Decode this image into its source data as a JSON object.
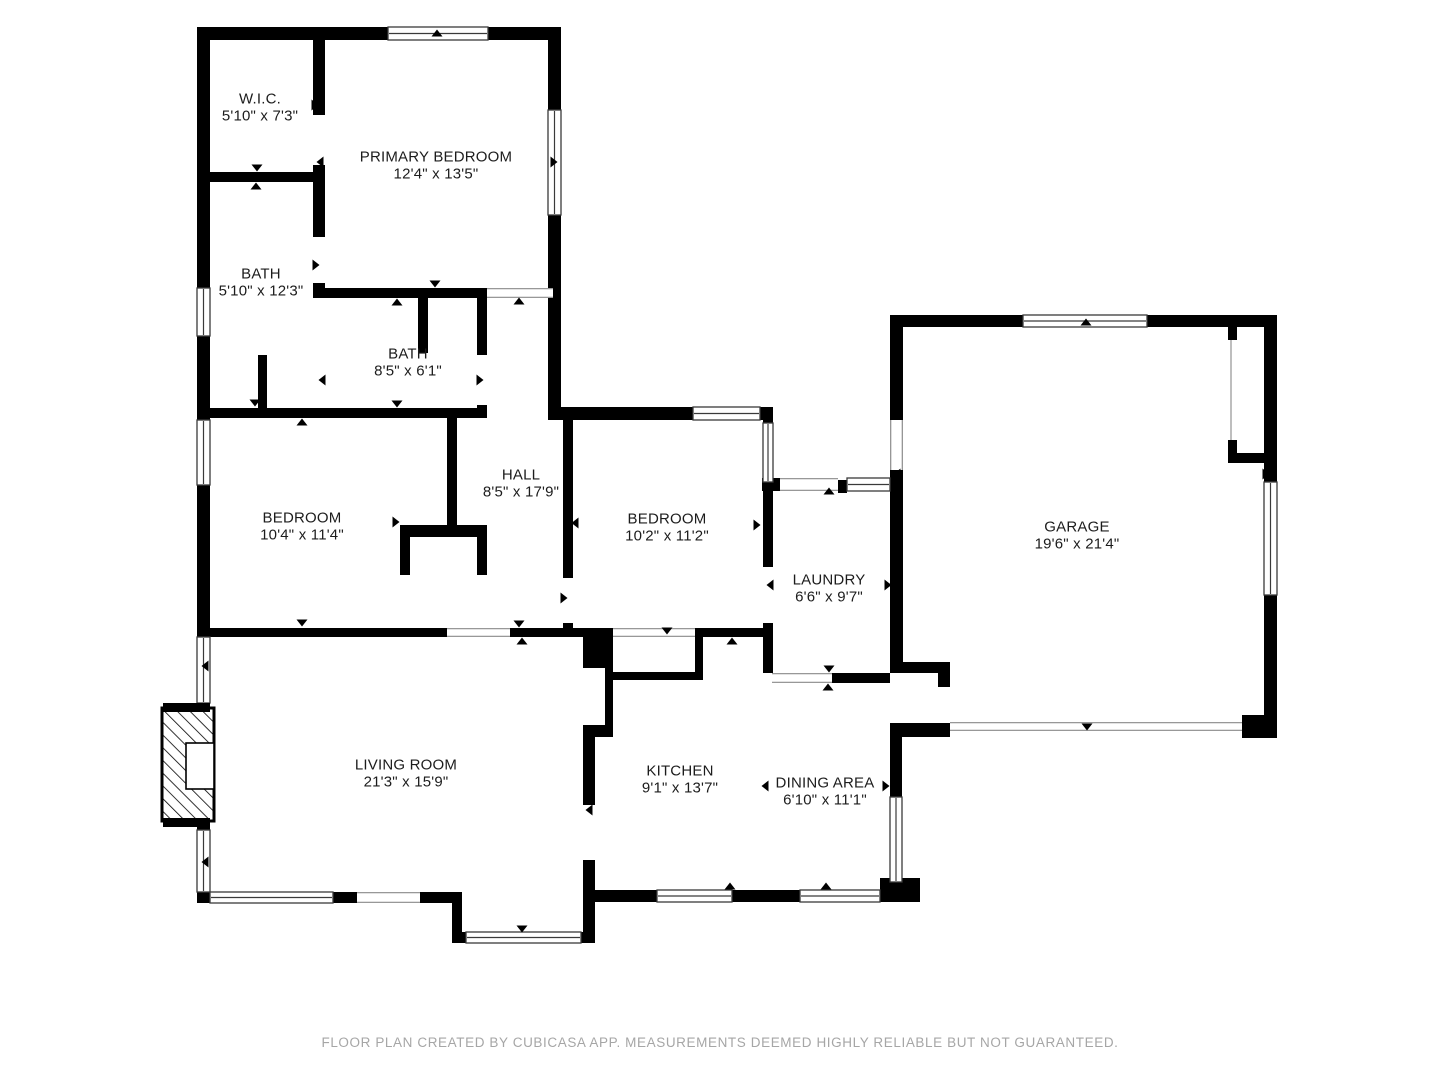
{
  "plan": {
    "creator_note": "FLOOR PLAN CREATED BY CUBICASA APP. MEASUREMENTS DEEMED HIGHLY RELIABLE BUT NOT GUARANTEED.",
    "colors": {
      "wall": "#000000",
      "label": "#1c1c1c",
      "footer": "#a6a6a6",
      "background": "#ffffff"
    }
  },
  "rooms": [
    {
      "id": "wic",
      "name": "W.I.C.",
      "dims": "5'10\" x 7'3\""
    },
    {
      "id": "primary-bedroom",
      "name": "PRIMARY BEDROOM",
      "dims": "12'4\" x 13'5\""
    },
    {
      "id": "bath-1",
      "name": "BATH",
      "dims": "5'10\" x 12'3\""
    },
    {
      "id": "bath-2",
      "name": "BATH",
      "dims": "8'5\" x 6'1\""
    },
    {
      "id": "hall",
      "name": "HALL",
      "dims": "8'5\" x 17'9\""
    },
    {
      "id": "bedroom-left",
      "name": "BEDROOM",
      "dims": "10'4\" x 11'4\""
    },
    {
      "id": "bedroom-right",
      "name": "BEDROOM",
      "dims": "10'2\" x 11'2\""
    },
    {
      "id": "laundry",
      "name": "LAUNDRY",
      "dims": "6'6\" x 9'7\""
    },
    {
      "id": "garage",
      "name": "GARAGE",
      "dims": "19'6\" x 21'4\""
    },
    {
      "id": "living-room",
      "name": "LIVING ROOM",
      "dims": "21'3\" x 15'9\""
    },
    {
      "id": "kitchen",
      "name": "KITCHEN",
      "dims": "9'1\" x 13'7\""
    },
    {
      "id": "dining-area",
      "name": "DINING AREA",
      "dims": "6'10\" x 11'1\""
    }
  ]
}
